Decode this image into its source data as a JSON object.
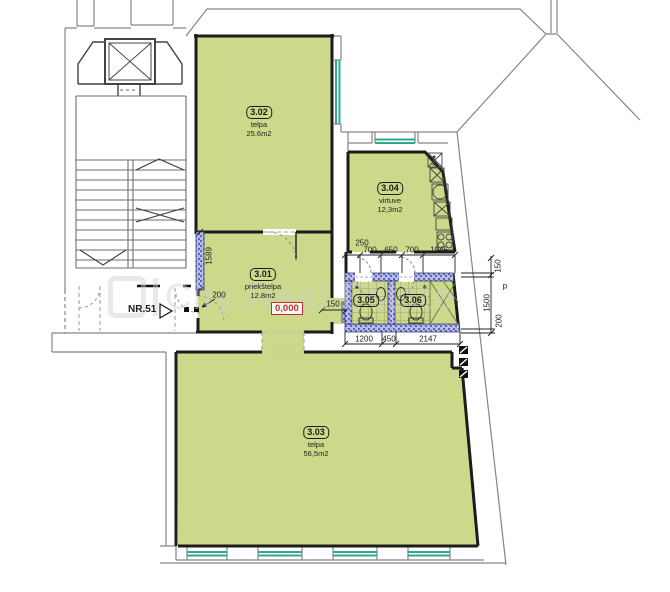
{
  "watermark": {
    "text": "City Real Estate"
  },
  "entrance": {
    "label": "NR.51"
  },
  "level_marker": {
    "value": "0,000"
  },
  "rooms": [
    {
      "id": "3.01",
      "name": "priekštelpa",
      "area": "12.8m2"
    },
    {
      "id": "3.02",
      "name": "telpa",
      "area": "25.6m2"
    },
    {
      "id": "3.03",
      "name": "telpa",
      "area": "56,5m2"
    },
    {
      "id": "3.04",
      "name": "virtuve",
      "area": "12,3m2"
    },
    {
      "id": "3.05"
    },
    {
      "id": "3.06"
    }
  ],
  "dimensions": {
    "kitchen_row_offset": "250",
    "kitchen_row": [
      "700",
      "650",
      "700",
      "1045"
    ],
    "bath_row": [
      "1200",
      "450",
      "2147"
    ],
    "left_wall": "1589",
    "entry_width": "200",
    "passage_width": "150",
    "right_top": "150",
    "right_middle": "1500",
    "right_bottom": "200",
    "right_p": "p"
  },
  "colors": {
    "room_fill": "#ccd98b",
    "wall_hatch": "#b6bde8",
    "window": "#2fa98c",
    "level_red": "#cc2a2a"
  }
}
